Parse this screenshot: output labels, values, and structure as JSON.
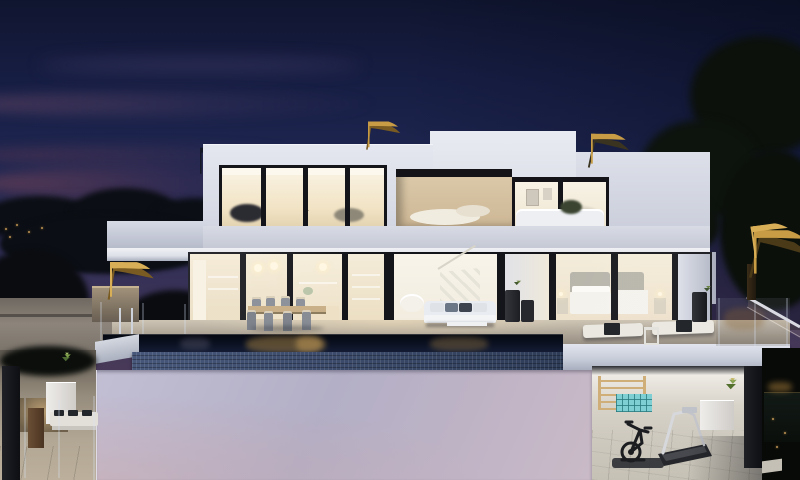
{
  "scene": {
    "description": "Twilight architectural render of a modern two-storey white villa with glowing warm interiors, uplit rooftop palm trees, an infinity-edge pool with mosaic tiles, a furnished terrace, and an open lower-level gym.",
    "time_of_day": "dusk",
    "regions": {
      "sky": {
        "label": "Deep blue dusk sky with pink and maroon cloud streaks on the left"
      },
      "backdrop": {
        "label": "Dark tree silhouettes and distant lights on the horizon"
      },
      "upper_floor": {
        "label": "Upper storey: glazed lounge windows, recessed beige terrace, bedroom wing with art on walls"
      },
      "ground_floor": {
        "label": "Ground floor glass wall revealing kitchen with pendant lamps, dining area, living room with staircase, and bedroom"
      },
      "terrace": {
        "label": "Stone pool deck with outdoor dining set, white lounge sofa, coffee table and potted palms"
      },
      "pool": {
        "label": "Dark infinity pool reflecting warm interior light, blue mosaic tile waterline band"
      },
      "lower_wall": {
        "label": "Tall lavender-pink rendered wall below the pool"
      },
      "lower_terrace": {
        "label": "Lower-left terrace with white planter, wooden unit and cushioned bench behind glass balustrade"
      },
      "gym": {
        "label": "Open-air lower-level gym with wooden wall bars, teal cube shelf, exercise bike, treadmill and palm planter"
      },
      "vegetation": {
        "label": "Golden uplit palm trees on the roof and flanks, dark evergreen masses on the right"
      }
    },
    "objects": [
      {
        "name": "roof-palm-left",
        "label": "Uplit palm above left roofline"
      },
      {
        "name": "roof-palm-right",
        "label": "Uplit palm above right roofline"
      },
      {
        "name": "planter-palm",
        "label": "Golden palm in concrete planter beside house"
      },
      {
        "name": "right-palm",
        "label": "Large golden palm on right garden side"
      },
      {
        "name": "outdoor-dining-set",
        "label": "Wood dining table with eight grey chairs"
      },
      {
        "name": "outdoor-sofa",
        "label": "White outdoor sofa with grey and navy cushions"
      },
      {
        "name": "coffee-table",
        "label": "Low white coffee table"
      },
      {
        "name": "sun-loungers",
        "label": "Two white sun loungers with dark towels"
      },
      {
        "name": "pool-ladder",
        "label": "Stainless pool ladder"
      },
      {
        "name": "wall-bars",
        "label": "Wooden gym wall bars"
      },
      {
        "name": "cube-shelf",
        "label": "Teal cube shelf"
      },
      {
        "name": "exercise-bike",
        "label": "Black exercise bike on mat"
      },
      {
        "name": "treadmill",
        "label": "Treadmill with white frame"
      },
      {
        "name": "bench",
        "label": "White bench with dark cushions"
      },
      {
        "name": "stair-railing",
        "label": "Descending glass stair railing on right"
      }
    ],
    "palette_note": "Hex colors sampled from the render"
  },
  "palette": {
    "sky-top": "#10152f",
    "sky-mid": "#1f2752",
    "sky-horizon": "#3d3459",
    "cloud-maroon": "#7a4456",
    "villa-white": "#e4e7ef",
    "villa-shade": "#c6cad7",
    "frame-dark": "#14151a",
    "interior-warm": "#f1e3c4",
    "terrace-beige": "#d9c7a7",
    "deck-stone": "#a89f92",
    "pool-dark": "#0b1122",
    "pool-tile": "#46577a",
    "wall-lavender": "#c2bed3",
    "wall-pink": "#cabac7",
    "palm-gold": "#c89c44",
    "palm-gold-bright": "#d8ae56",
    "palm-gold-dark": "#7a5c22",
    "foliage-dark": "#0b0e14",
    "foliage-green": "#4e6b33",
    "gym-wall": "#d8d3c9",
    "gym-floor": "#cfcabf",
    "teal-shelf": "#7ecfd4",
    "wood-bars": "#cfae77",
    "equipment-dark": "#1b1d21",
    "equipment-light": "#d6d8dc",
    "planter-white": "#efedea",
    "column-dark": "#0e0f13"
  }
}
